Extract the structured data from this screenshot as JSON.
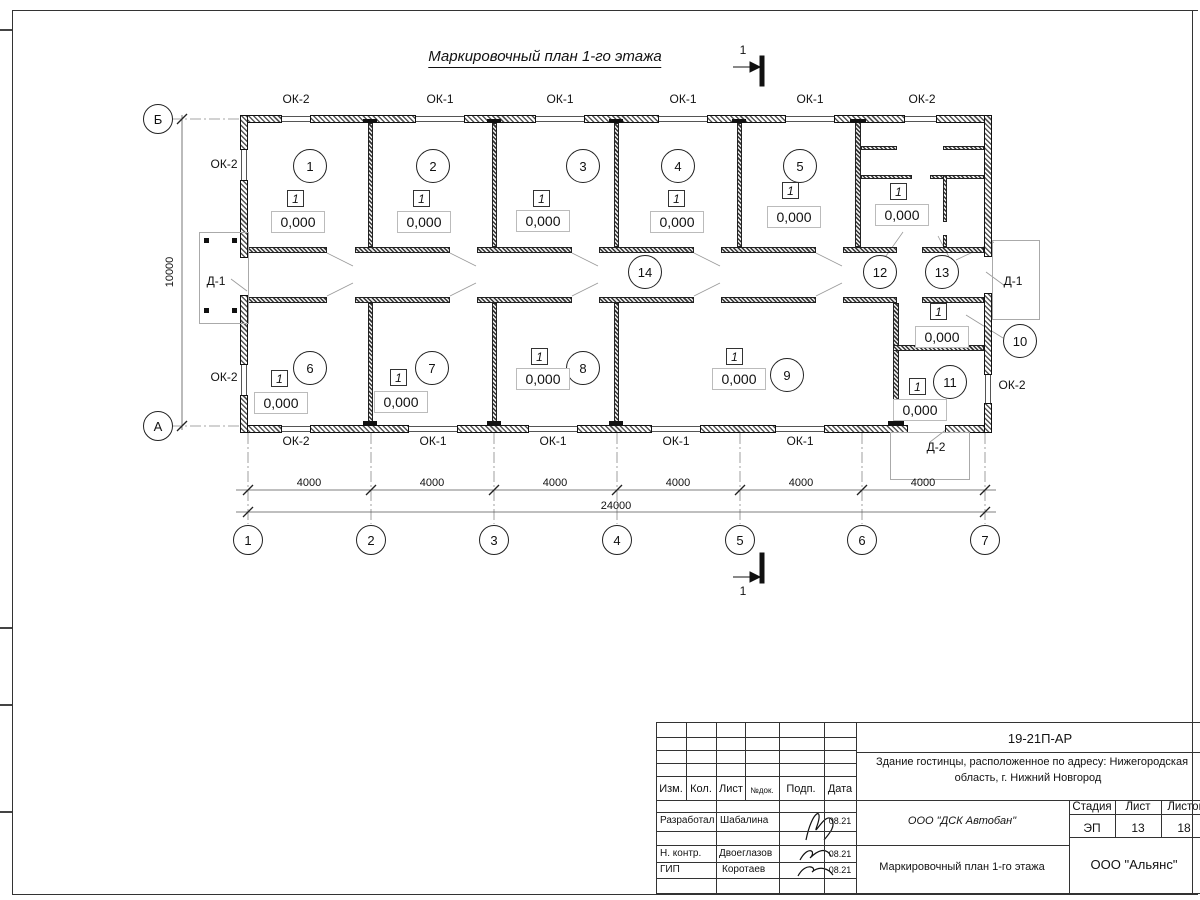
{
  "sheet": {
    "title": "Маркировочный план 1-го этажа",
    "section_label": "1"
  },
  "plan": {
    "floor_mark": "1",
    "elevation": "0,000",
    "axis_top_left": "Б",
    "axis_bottom_left": "А",
    "axes_bottom": [
      "1",
      "2",
      "3",
      "4",
      "5",
      "6",
      "7"
    ],
    "window_labels_top": [
      "ОК-2",
      "ОК-1",
      "ОК-1",
      "ОК-1",
      "ОК-1",
      "ОК-2"
    ],
    "window_labels_bottom": [
      "ОК-2",
      "ОК-1",
      "ОК-1",
      "ОК-1",
      "ОК-1"
    ],
    "label_left_upper": "ОК-2",
    "label_left_lower": "ОК-2",
    "label_right": "ОК-2",
    "door_left": "Д-1",
    "door_right": "Д-1",
    "door_bottom": "Д-2",
    "dims": [
      "4000",
      "4000",
      "4000",
      "4000",
      "4000",
      "4000"
    ],
    "dim_total": "24000",
    "dim_height": "10000",
    "rooms": [
      "1",
      "2",
      "3",
      "4",
      "5",
      "6",
      "7",
      "8",
      "9",
      "10",
      "11",
      "12",
      "13",
      "14"
    ]
  },
  "title_block": {
    "code": "19-21П-АР",
    "project_line1": "Здание гостинцы, расположенное по адресу: Нижегородская",
    "project_line2": "область, г. Нижний Новгород",
    "col_izm": "Изм.",
    "col_kol": "Кол.",
    "col_list": "Лист",
    "col_ndok": "№док.",
    "col_podp": "Подп.",
    "col_data": "Дата",
    "rows": [
      {
        "role": "Разработал",
        "name": "Шабалина",
        "date": "08.21"
      },
      {
        "role": "Н. контр.",
        "name": "Двоеглазов",
        "date": "08.21"
      },
      {
        "role": "ГИП",
        "name": "Коротаев",
        "date": "08.21"
      }
    ],
    "org": "ООО \"ДСК Автобан\"",
    "stage_label": "Стадия",
    "sheet_label": "Лист",
    "sheets_label": "Листов",
    "stage": "ЭП",
    "sheet_no": "13",
    "sheets_total": "18",
    "doc_title": "Маркировочный план 1-го этажа",
    "company": "ООО \"Альянс\""
  }
}
